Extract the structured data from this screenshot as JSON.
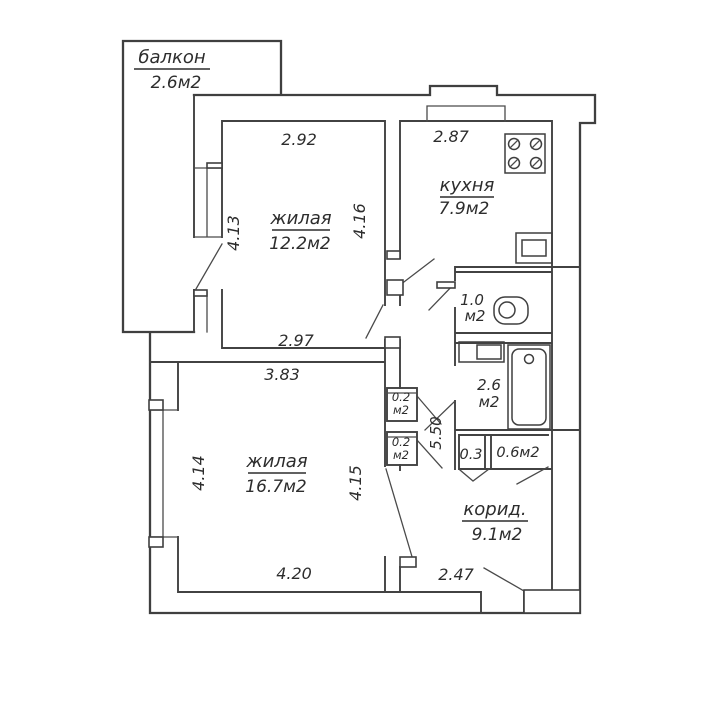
{
  "colors": {
    "wall_line": "#3f3f3f",
    "text": "#2d2d2d",
    "background": "#ffffff"
  },
  "balcony": {
    "name": "балкон",
    "area": "2.6м2"
  },
  "living_room_small": {
    "name": "жилая",
    "area": "12.2м2",
    "dim_top": "2.92",
    "dim_left": "4.13",
    "dim_bottom": "2.97"
  },
  "kitchen": {
    "name": "кухня",
    "area": "7.9м2",
    "dim_top": "2.87",
    "dim_side": "4.16"
  },
  "wc": {
    "area_value": "1.0",
    "area_unit": "м2"
  },
  "bathroom": {
    "area_value": "2.6",
    "area_unit": "м2"
  },
  "living_room_large": {
    "name": "жилая",
    "area": "16.7м2",
    "dim_top": "3.83",
    "dim_left": "4.14",
    "dim_right": "4.15",
    "dim_bottom": "4.20"
  },
  "closet_upper": {
    "area_value": "0.2",
    "area_unit": "м2"
  },
  "closet_lower": {
    "area_value": "0.2",
    "area_unit": "м2"
  },
  "niche_small": {
    "area": "0.3"
  },
  "niche_large": {
    "area": "0.6м2"
  },
  "hallway": {
    "dim_length": "5.50"
  },
  "corridor": {
    "name": "корид.",
    "area": "9.1м2",
    "dim_bottom": "2.47"
  },
  "fixtures": [
    "stove-icon",
    "kitchen-sink-icon",
    "toilet-icon",
    "washbasin-icon",
    "bathtub-icon"
  ]
}
